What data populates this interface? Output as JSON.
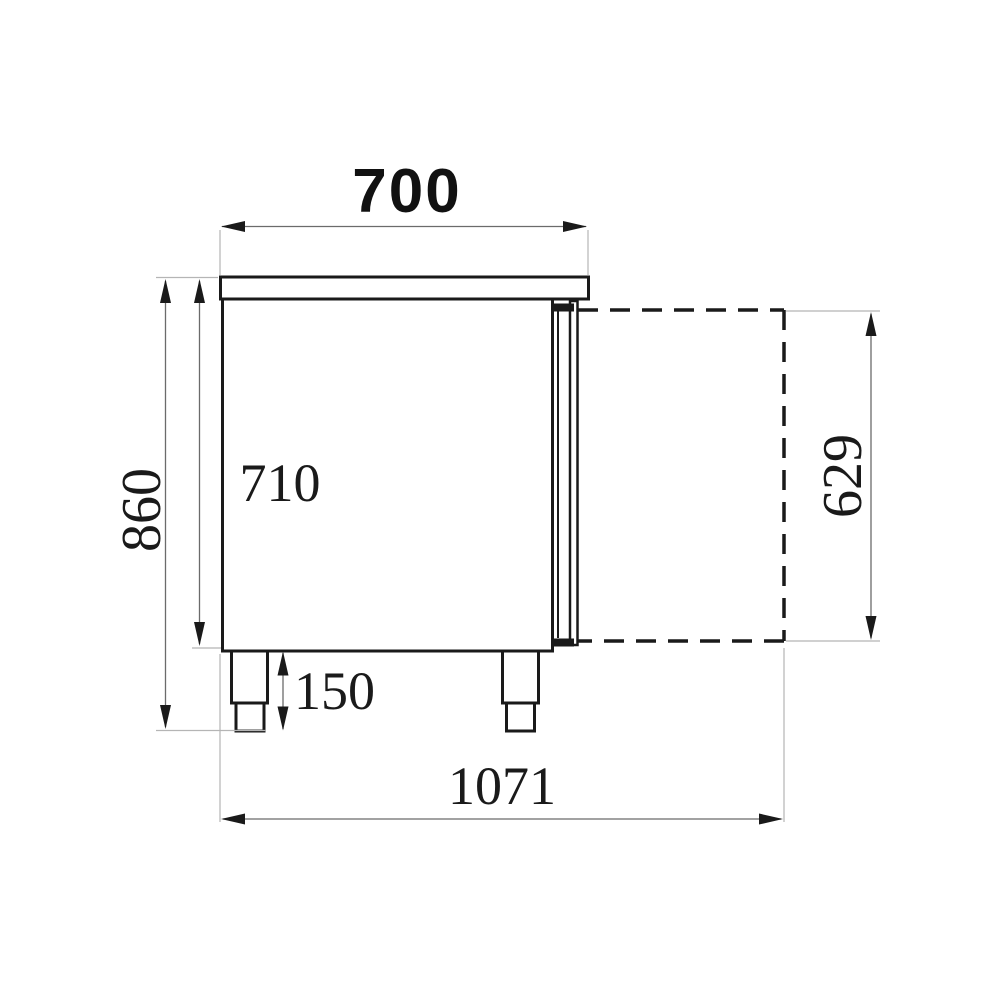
{
  "palette": {
    "background": "#ffffff",
    "structure_line": "#1a1a1a",
    "dimension_line": "#6b6b6b",
    "extension_line": "#b5b5b5",
    "text": "#1a1a1a"
  },
  "drawing": {
    "kind": "side-view technical dimension drawing",
    "labels": {
      "top_depth": "700",
      "overall_height": "860",
      "body_height": "710",
      "leg_height": "150",
      "door_height": "629",
      "total_depth_door_open": "1071"
    }
  }
}
